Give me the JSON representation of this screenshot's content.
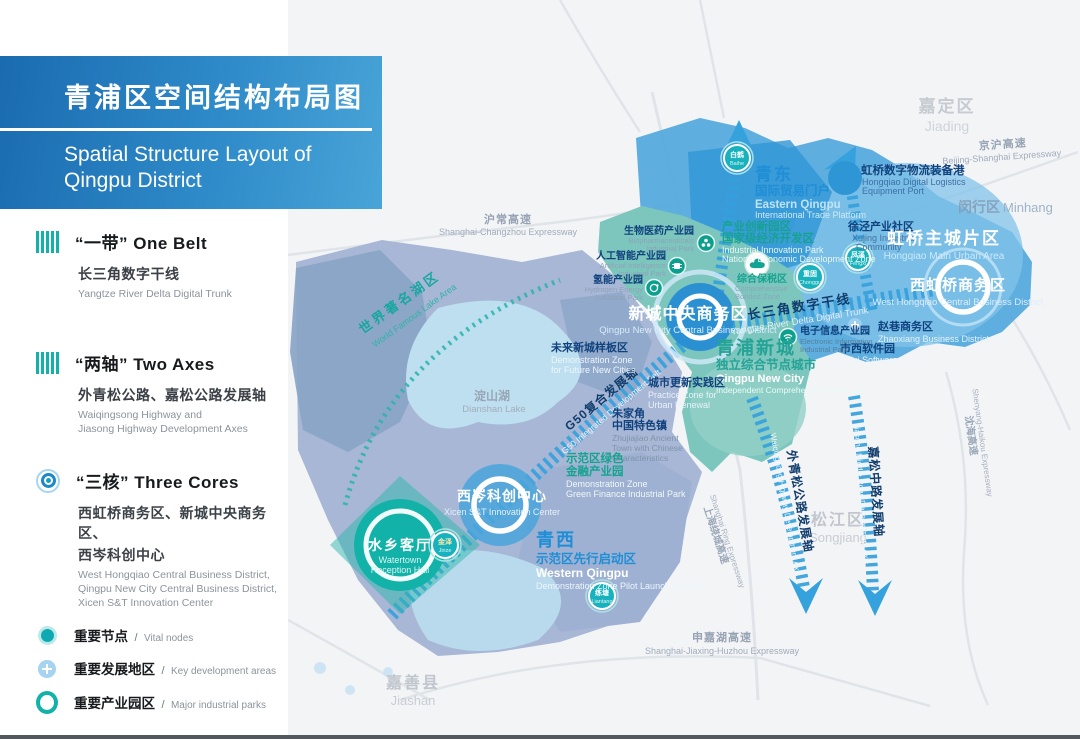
{
  "title": {
    "zh": "青浦区空间结构布局图",
    "en1": "Spatial Structure Layout of",
    "en2": "Qingpu District"
  },
  "colors": {
    "accent_blue": "#2f96d6",
    "teal": "#12b1aa",
    "title_gradient_start": "#1a6bb0",
    "title_gradient_end": "#49a4d8"
  },
  "legend": {
    "belt": {
      "title": "“一带” One Belt",
      "zh": "长三角数字干线",
      "en": "Yangtze River Delta Digital Trunk"
    },
    "axes": {
      "title": "“两轴” Two Axes",
      "zh": "外青松公路、嘉松公路发展轴",
      "en1": "Waiqingsong Highway and",
      "en2": "Jiasong Highway Development Axes"
    },
    "cores": {
      "title": "“三核” Three Cores",
      "zh1": "西虹桥商务区、新城中央商务区、",
      "zh2": "西岑科创中心",
      "en1": "West Hongqiao Central Business District,",
      "en2": "Qingpu New City Central Business District,",
      "en3": "Xicen S&T Innovation Center"
    },
    "markers": {
      "sep": "/",
      "vital": {
        "zh": "重要节点",
        "en": "Vital nodes"
      },
      "keydev": {
        "zh": "重要发展地区",
        "en": "Key development areas"
      },
      "parks": {
        "zh": "重要产业园区",
        "en": "Major industrial parks"
      }
    }
  },
  "map": {
    "neighbors": {
      "jiading_zh": "嘉定区",
      "jiading_en": "Jiading",
      "minhang_zh": "闵行区",
      "minhang_en": "Minhang",
      "songjiang_zh": "松江区",
      "songjiang_en": "Songjiang",
      "jiashan_zh": "嘉善县",
      "jiashan_en": "Jiashan",
      "dianshan_zh": "淀山湖",
      "dianshan_en": "Dianshan Lake"
    },
    "expressways": {
      "huchang_zh": "沪常高速",
      "huchang_en": "Shanghai-Changzhou Expressway",
      "jinghu_zh": "京沪高速",
      "jinghu_en": "Beijing-Shanghai Expressway",
      "shenjiahu_zh": "申嘉湖高速",
      "shenjiahu_en": "Shanghai-Jiaxing-Huzhou Expressway",
      "raocheng_zh": "上海绕城高速",
      "raocheng_en": "Shanghai Ring Expressway",
      "shenhai_zh": "沈海高速",
      "shenhai_en": "Shenyang-Haikou Expressway"
    },
    "axes": {
      "trunk_zh": "长三角数字干线",
      "trunk_en": "Yangtze River Delta Digital Trunk",
      "g50_zh": "G50复合发展轴",
      "g50_en": "G50 Integrated Development Belt",
      "waiqingsong_zh": "外青松公路发展轴",
      "waiqingsong_en": "Waiqingsong Highway Development Axis",
      "jiasong_zh": "嘉松中路发展轴",
      "jiasong_en": "Jiasong Middle Road Development Axis",
      "lake_zh": "世界著名湖区",
      "lake_en": "World Famous Lake Area"
    },
    "zones": {
      "qingdong_zh": "青东",
      "qingdong_sub": "国际贸易门户",
      "qingdong_en1": "Eastern Qingpu",
      "qingdong_en2": "International Trade Platform",
      "innov_zh1": "产业创新园区",
      "innov_zh2": "国家级经济开发区",
      "innov_en1": "Industrial Innovation Park",
      "innov_en2": "National Economic Development Zone",
      "logistics_zh": "虹桥数字物流装备港",
      "logistics_en1": "Hongqiao Digital Logistics",
      "logistics_en2": "Equipment Port",
      "xujing_zh": "徐泾产业社区",
      "xujing_en1": "Xujing Industrial",
      "xujing_en2": "Community",
      "hongqiao_zh": "虹桥主城片区",
      "hongqiao_en": "Hongqiao Main Urban Area",
      "westhq_zh": "西虹桥商务区",
      "westhq_en": "West Hongqiao Central Business District",
      "zhaoxiang_zh": "赵巷商务区",
      "zhaoxiang_en": "Zhaoxiang Business District",
      "shixi_zh": "市西软件园",
      "shixi_en": "Shixi Software Park",
      "cbd_zh": "新城中央商务区",
      "cbd_en": "Qingpu New City Central Business District",
      "newcity_zh": "青浦新城",
      "newcity_sub": "独立综合节点城市",
      "newcity_en1": "Qingpu New City",
      "newcity_en2": "Independent Comprehensive Node City",
      "renewal_zh": "城市更新实践区",
      "renewal_en1": "Practice Zone for",
      "renewal_en2": "Urban Renewal",
      "future_zh": "未来新城样板区",
      "future_en1": "Demonstration Zone",
      "future_en2": "for Future New Cities",
      "zhujiajiao_zh1": "朱家角",
      "zhujiajiao_zh2": "中国特色镇",
      "zhujiajiao_en1": "Zhujiajiao Ancient",
      "zhujiajiao_en2": "Town with Chinese",
      "zhujiajiao_en3": "Characteristics",
      "finance_zh1": "示范区绿色",
      "finance_zh2": "金融产业园",
      "finance_en1": "Demonstration Zone",
      "finance_en2": "Green Finance Industrial Park",
      "qingxi_zh": "青西",
      "qingxi_sub": "示范区先行启动区",
      "qingxi_en1": "Western Qingpu",
      "qingxi_en2": "Demonstration Zone Pilot Launching Area",
      "xicen_zh": "西岑科创中心",
      "xicen_en": "Xicen S&T Innovation Center",
      "watertown_zh": "水乡客厅",
      "watertown_en1": "Watertown",
      "watertown_en2": "Reception Hall"
    },
    "parks": {
      "bio_zh": "生物医药产业园",
      "bio_en1": "Biopharmaceuticals",
      "bio_en2": "Industrial Park",
      "ai_zh": "人工智能产业园",
      "ai_en1": "Artificial Intelligence",
      "ai_en2": "Industrial Park",
      "hydrogen_zh": "氢能产业园",
      "hydrogen_en1": "Hydrogen Energy",
      "hydrogen_en2": "Industrial Park",
      "einfo_zh": "电子信息产业园",
      "einfo_en1": "Electronic Information",
      "einfo_en2": "Industrial Park",
      "bonded_zh": "综合保税区",
      "bonded_en1": "Comprehensive",
      "bonded_en2": "Bonded Zone"
    },
    "nodes": {
      "baihe_zh": "白鹤",
      "baihe_en": "Baihe",
      "chonggu_zh": "重固",
      "chonggu_en": "Chonggu",
      "fengxi_zh": "凤溪",
      "fengxi_en": "Fengxi",
      "jinze_zh": "金泽",
      "jinze_en": "Jinze",
      "liantang_zh": "练塘",
      "liantang_en": "Liantang"
    }
  }
}
